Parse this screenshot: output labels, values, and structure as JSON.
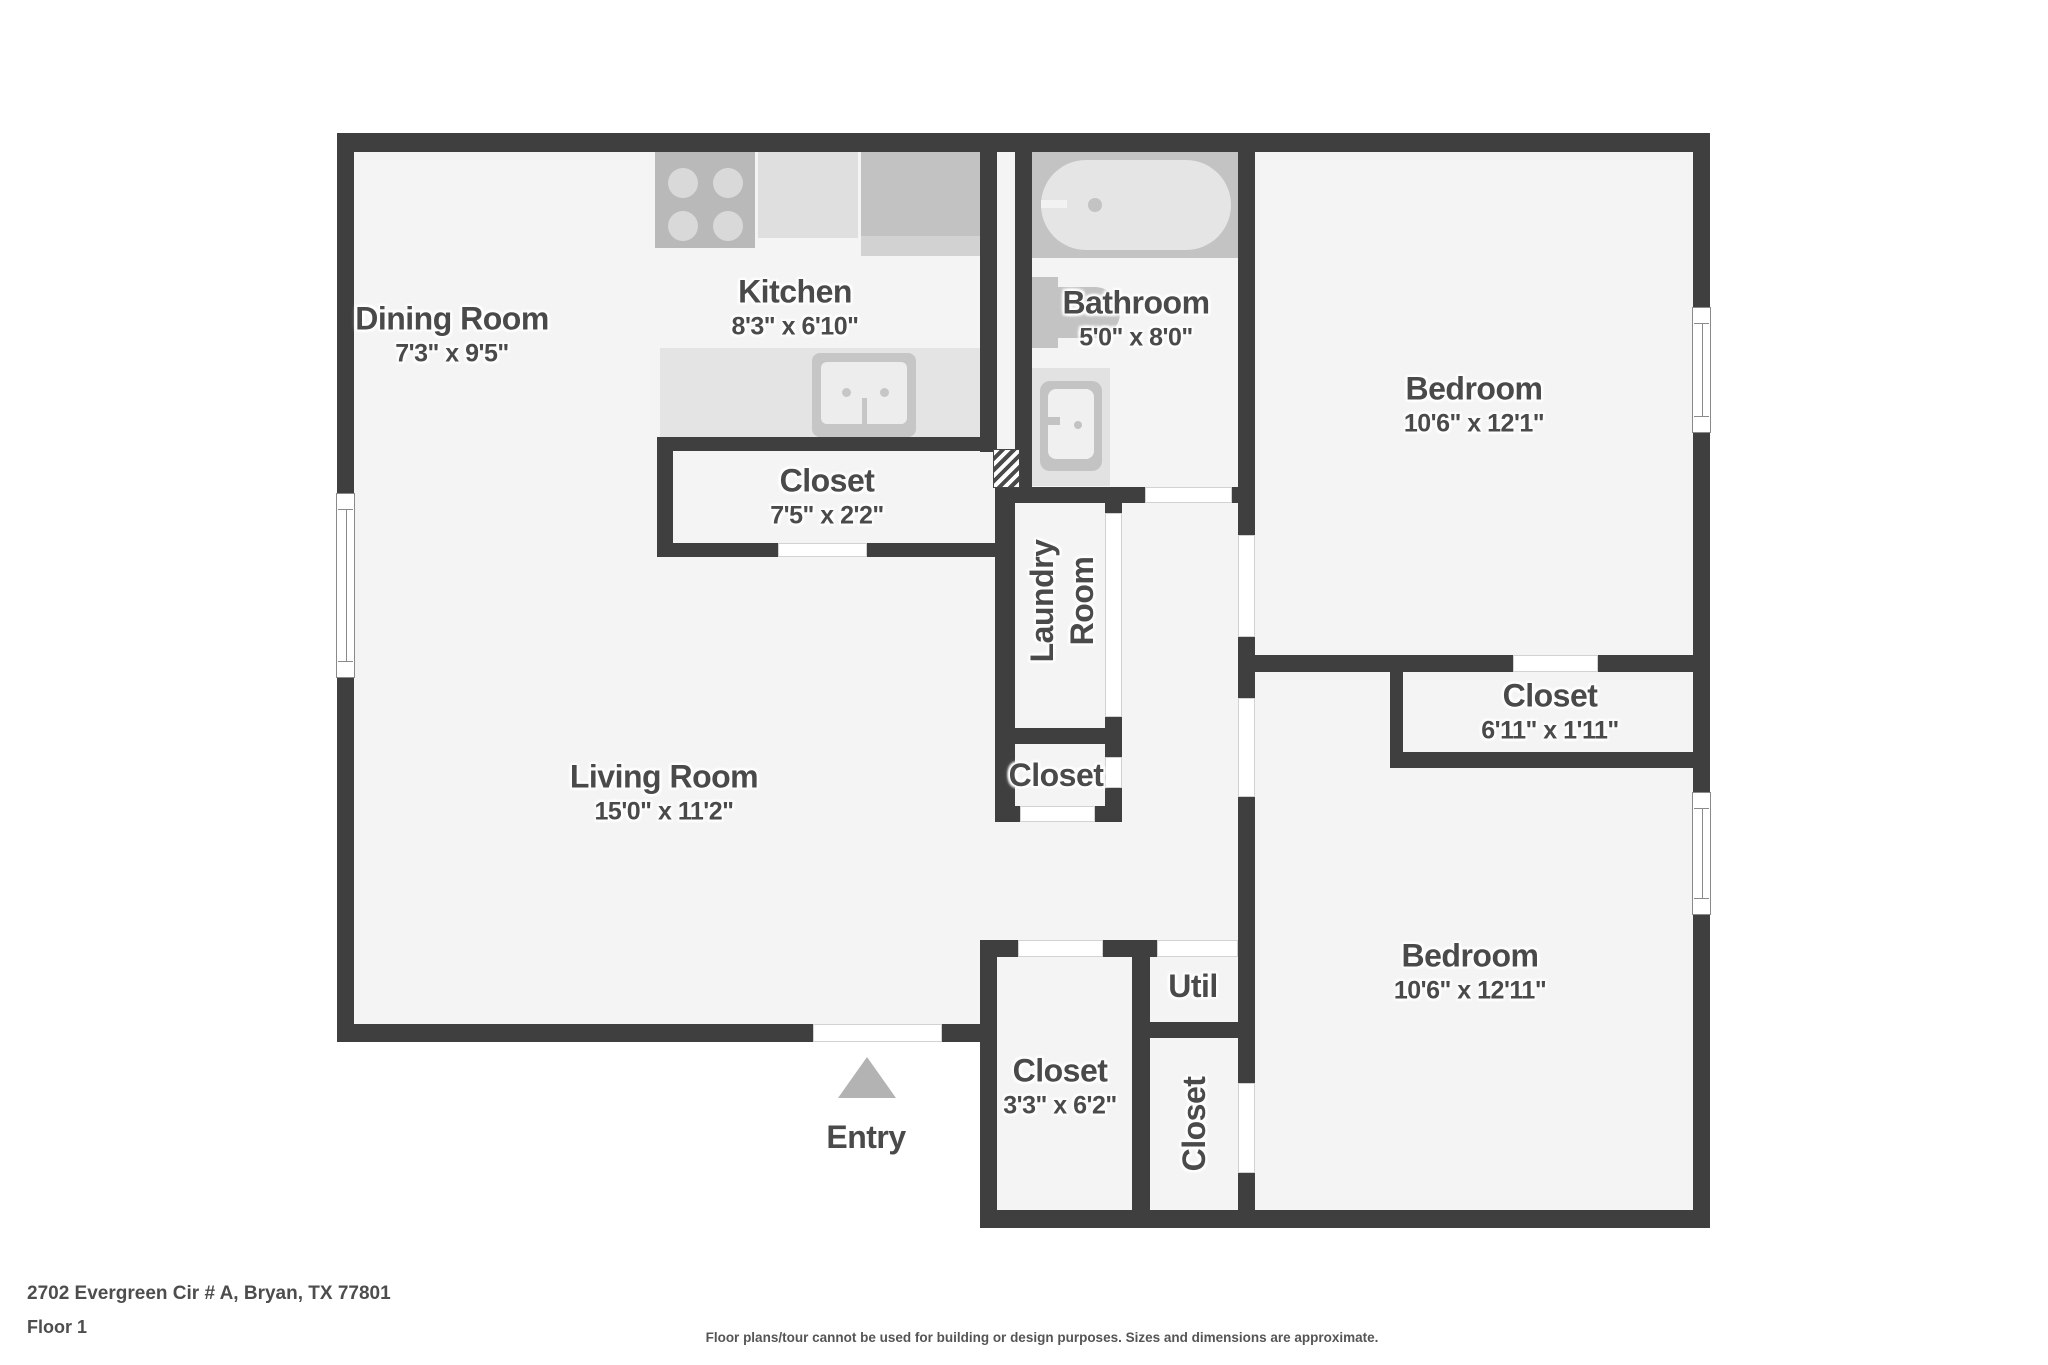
{
  "palette": {
    "wall": "#3f3f3f",
    "floor": "#f4f4f4",
    "fixture_light": "#e3e3e3",
    "fixture_mid": "#c3c3c3",
    "fixture_dark": "#b9b9b9",
    "label_text": "#4a4a4a",
    "entry_arrow": "#b3b3b3"
  },
  "rooms": {
    "dining": {
      "name": "Dining Room",
      "dims": "7'3\" x 9'5\""
    },
    "kitchen": {
      "name": "Kitchen",
      "dims": "8'3\" x 6'10\""
    },
    "bathroom": {
      "name": "Bathroom",
      "dims": "5'0\" x 8'0\""
    },
    "bedroom_top": {
      "name": "Bedroom",
      "dims": "10'6\" x 12'1\""
    },
    "closet_kitchen": {
      "name": "Closet",
      "dims": "7'5\" x 2'2\""
    },
    "laundry": {
      "name_line1": "Laundry",
      "name_line2": "Room"
    },
    "closet_hall": {
      "name": "Closet"
    },
    "closet_bedroom_top": {
      "name": "Closet",
      "dims": "6'11\" x 1'11\""
    },
    "living": {
      "name": "Living Room",
      "dims": "15'0\" x 11'2\""
    },
    "closet_entry": {
      "name": "Closet",
      "dims": "3'3\" x 6'2\""
    },
    "util": {
      "name": "Util"
    },
    "closet_bedroom_bottom": {
      "name": "Closet"
    },
    "bedroom_bottom": {
      "name": "Bedroom",
      "dims": "10'6\" x 12'11\""
    },
    "entry": {
      "name": "Entry"
    }
  },
  "icons": {
    "stove": "four-burner-cooktop",
    "kitchen_sink": "double-basin-sink",
    "bathtub": "bathtub-top-view",
    "toilet": "toilet-top-view",
    "bathroom_sink": "vanity-sink",
    "entry_arrow": "up-triangle",
    "utility_shaft": "diagonal-hatch"
  },
  "footer": {
    "address": "2702 Evergreen Cir # A, Bryan, TX 77801",
    "floor": "Floor 1",
    "disclaimer": "Floor plans/tour cannot be used for building or design purposes. Sizes and dimensions are approximate."
  }
}
